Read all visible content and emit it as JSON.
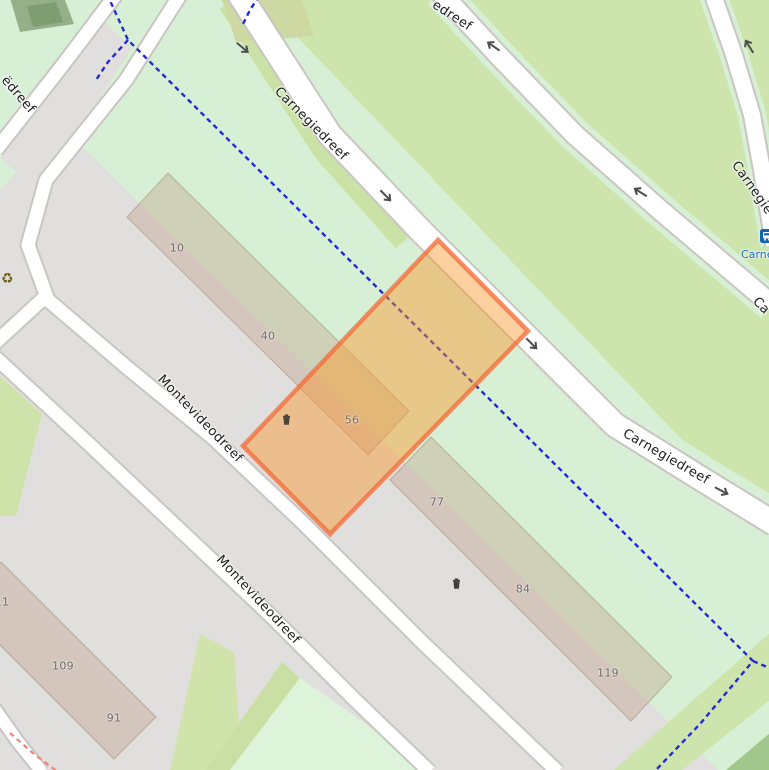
{
  "map": {
    "streets": {
      "carnegiedreef_1": "Carnegiedreef",
      "carnegiedreef_2": "Carnegiedreef",
      "carnegiedreef_top_partial": "edreef",
      "carnegiedreef_right_partial": "Carnegie",
      "carnegiedreef_right_lower_partial": "Ca",
      "brazilie_partial": "ëdreef",
      "montevideodreef_1": "Montevideodreef",
      "montevideodreef_2": "Montevideodreef"
    },
    "house_numbers": [
      {
        "value": "10"
      },
      {
        "value": "40"
      },
      {
        "value": "56"
      },
      {
        "value": "77"
      },
      {
        "value": "84"
      },
      {
        "value": "119"
      },
      {
        "value": "109"
      },
      {
        "value": "91"
      },
      {
        "value": "11"
      }
    ],
    "transit": {
      "bus_stop_name": "Carneg"
    },
    "icons": {
      "recycling": "♻"
    },
    "colors": {
      "selection_fill": "#FA9632",
      "selection_border": "#F26E3C",
      "cycleway_blue": "#2328D8",
      "footpath_red": "#EE8576",
      "transit_blue": "#1470C4",
      "grass_green": "#CDE4AD",
      "park_mint": "#D7F0D5",
      "residential_gray": "#E0DFDD"
    }
  }
}
